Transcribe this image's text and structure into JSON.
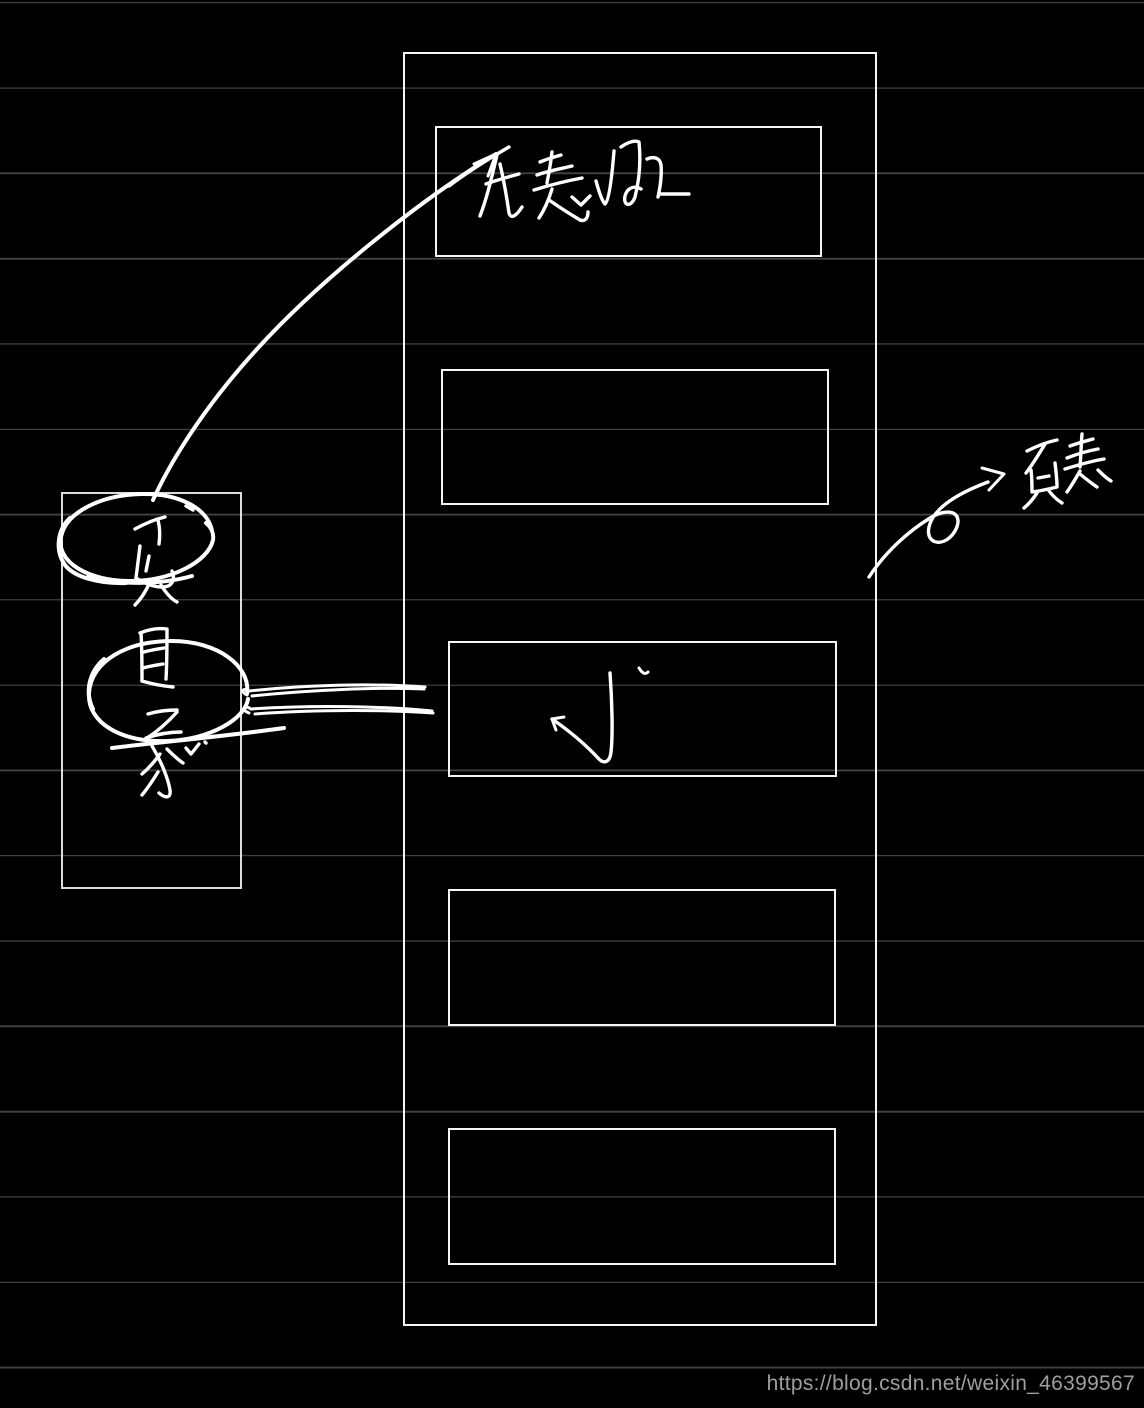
{
  "canvas": {
    "background_color": "#000000",
    "grid_line_color": "#424242",
    "ink_color": "#ffffff"
  },
  "labels": {
    "page_table_entry": "页表项",
    "page": "页",
    "directory": "目录",
    "page_table": "页表"
  },
  "watermark": {
    "text": "https://blog.csdn.net/weixin_46399567",
    "color": "#9e9e9e"
  }
}
